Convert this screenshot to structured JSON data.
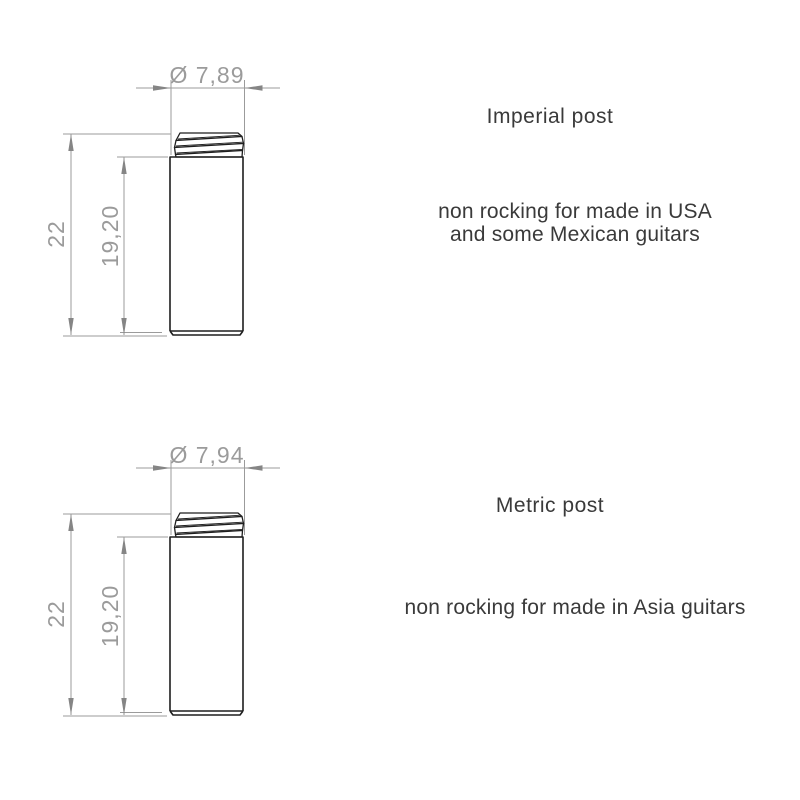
{
  "page": {
    "background": "#ffffff"
  },
  "colors": {
    "part_outline": "#1e1e1e",
    "dimension_lines": "#9b9b9b",
    "dimension_text": "#9b9b9b",
    "label_text": "#3a3a3a"
  },
  "drawings": [
    {
      "id": "imperial",
      "title": "Imperial post",
      "description": "non rocking for made in USA\nand some Mexican guitars",
      "dimensions": {
        "diameter": "Ø 7,89",
        "total_height": "22",
        "body_height": "19,20"
      }
    },
    {
      "id": "metric",
      "title": "Metric post",
      "description": "non rocking for made in Asia guitars",
      "dimensions": {
        "diameter": "Ø 7,94",
        "total_height": "22",
        "body_height": "19,20"
      }
    }
  ]
}
